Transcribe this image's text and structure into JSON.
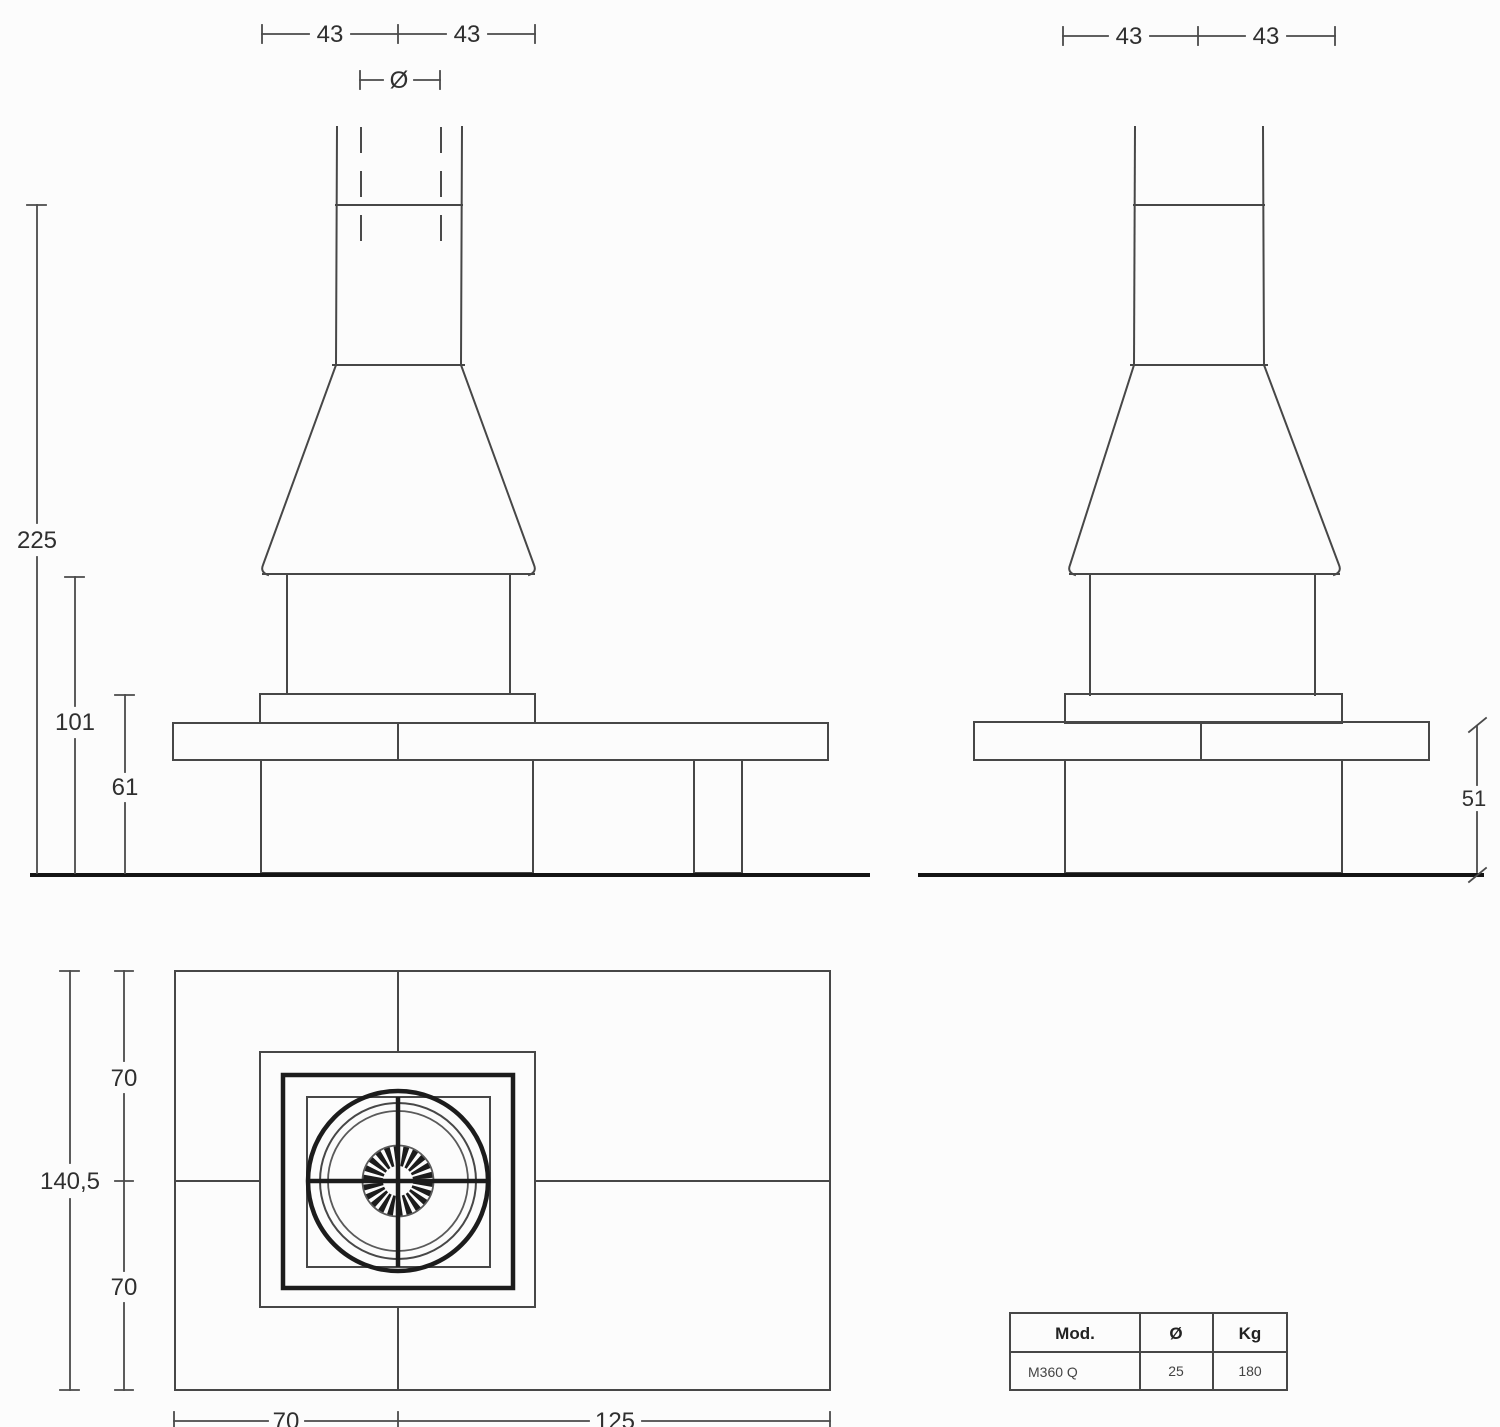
{
  "palette": {
    "background": "#fcfcfc",
    "line": "#474747",
    "bold_line": "#1c1c1c",
    "text": "#2f2f2f"
  },
  "front_view": {
    "dim_hood_half_width_left": "43",
    "dim_hood_half_width_right": "43",
    "dim_flue_diameter_symbol": "Ø",
    "dim_total_height": "225",
    "dim_hood_bottom_height": "101",
    "dim_mantel_height": "61"
  },
  "side_view": {
    "dim_hood_half_width_left": "43",
    "dim_hood_half_width_right": "43",
    "dim_bench_top_height": "51"
  },
  "plan_view": {
    "dim_total_depth": "140,5",
    "dim_depth_back_half": "70",
    "dim_depth_front_half": "70",
    "dim_width_left_section": "70",
    "dim_width_right_section": "125"
  },
  "spec_table": {
    "headers": [
      "Mod.",
      "Ø",
      "Kg"
    ],
    "row": [
      "M360 Q",
      "25",
      "180"
    ]
  }
}
